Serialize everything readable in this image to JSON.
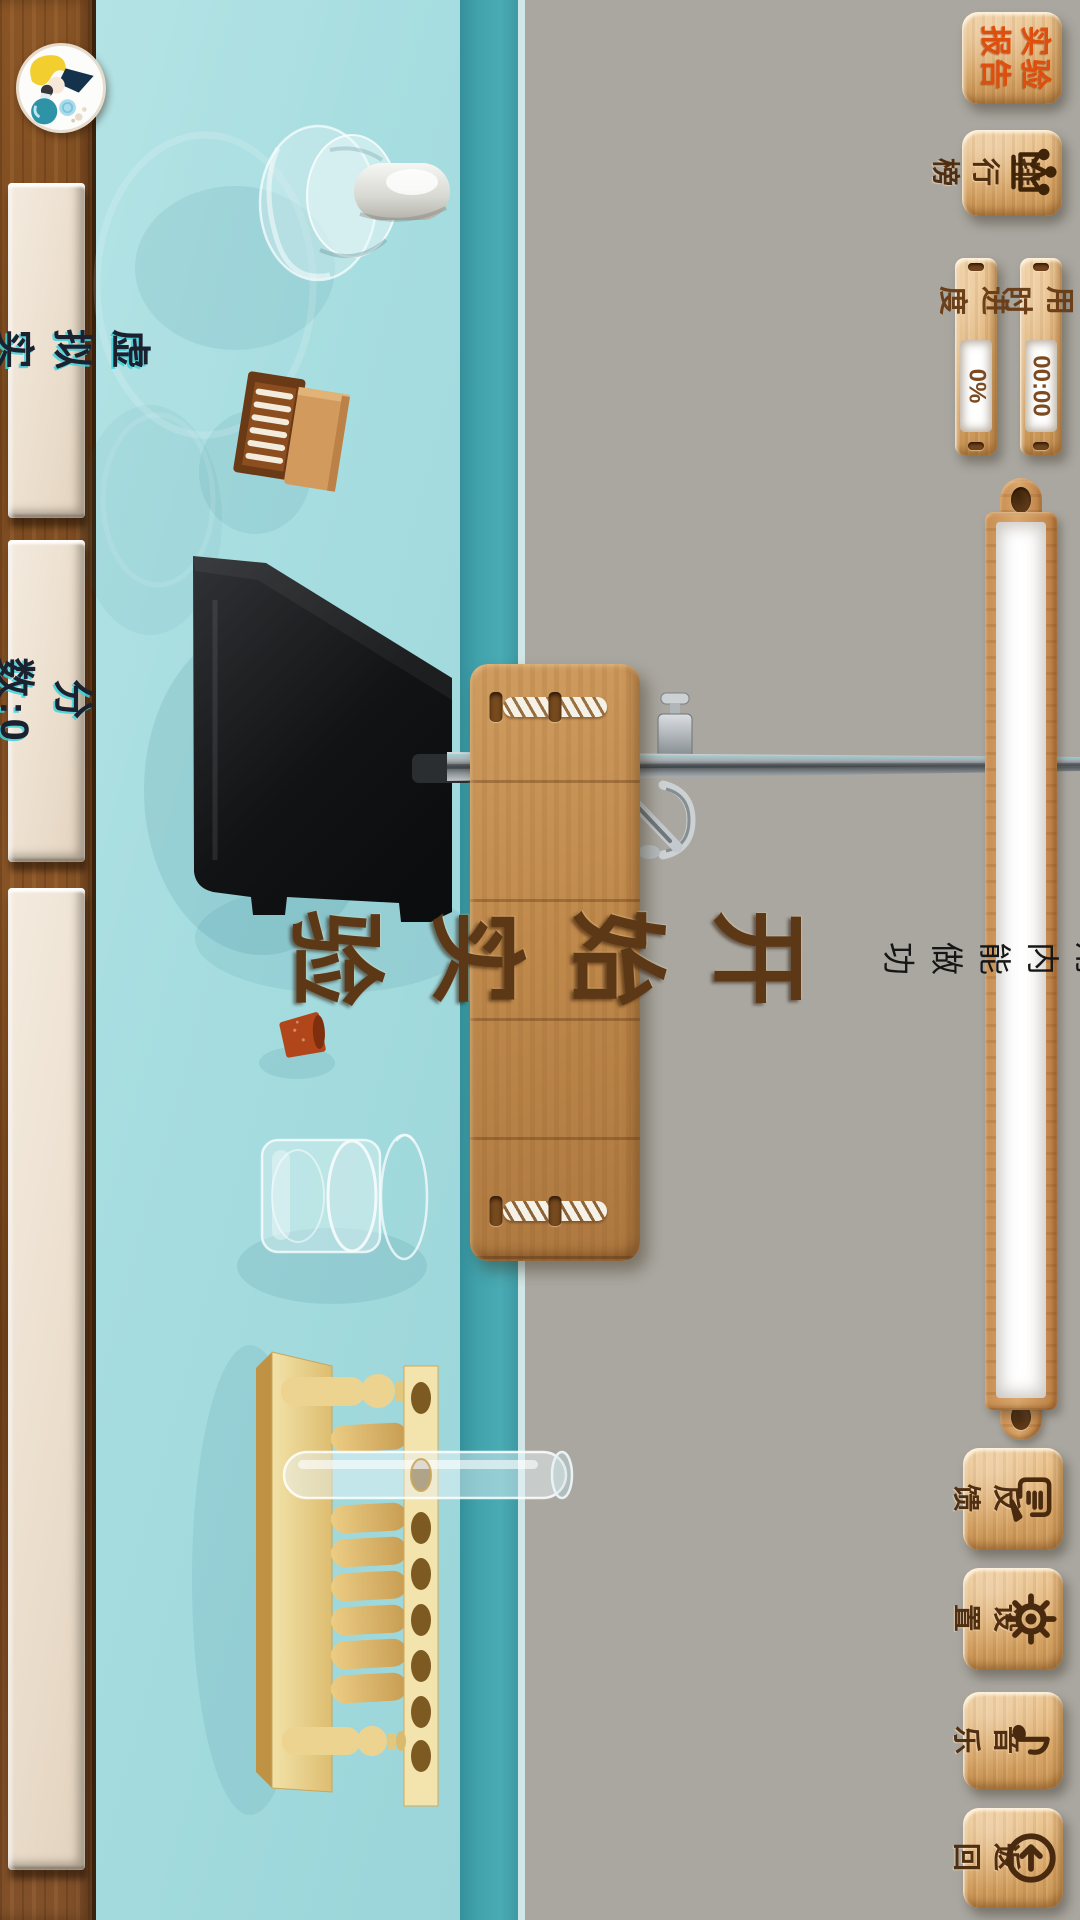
{
  "sidebar": {
    "virtual_lab": "虚拟实验",
    "score": "分数:0"
  },
  "main": {
    "start_label": "开始实验",
    "experiment_title": "利用内能做功"
  },
  "topbar": {
    "report": "实验\n报告",
    "leaderboard": "排行榜",
    "time_label": "用时",
    "time_value": "00:00",
    "progress_label": "进度",
    "progress_value": "0%"
  },
  "bottombar": {
    "feedback": "反馈",
    "settings": "设置",
    "music": "音乐",
    "back": "返回"
  },
  "icons": {
    "avatar": "scientist-avatar",
    "leaderboard": "crown-icon",
    "feedback": "speech-bubble-pencil-icon",
    "settings": "gear-icon",
    "music": "music-note-icon",
    "back": "back-arrow-circle-icon"
  },
  "equipment": [
    "dropper-bottle",
    "matchbox",
    "iron-stand",
    "rubber-stopper",
    "beaker",
    "test-tube-rack",
    "test-tube"
  ],
  "colors": {
    "bench": "#a6dde0",
    "bench_edge": "#3e9da7",
    "background_gray": "#a9a7a0",
    "wood_sidebar": "#7b4a1f",
    "wood_button": "#dcab6c",
    "panel_beige": "#ede1d2",
    "report_text": "#de4f0e",
    "engraving": "#4f2e12",
    "sign_text": "#5c3816"
  }
}
